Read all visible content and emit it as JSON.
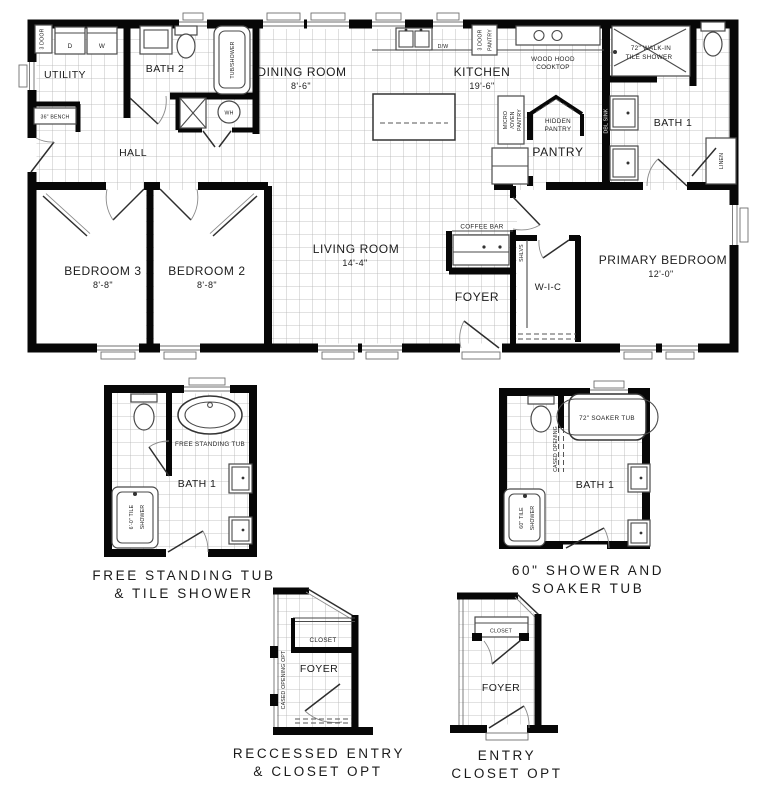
{
  "plan": {
    "rooms": {
      "utility": "UTILITY",
      "bath2": "BATH 2",
      "hall": "HALL",
      "dining": "DINING ROOM",
      "dining_dim": "8'-6\"",
      "kitchen": "KITCHEN",
      "kitchen_dim": "19'-6\"",
      "pantry": "PANTRY",
      "bath1": "BATH 1",
      "living": "LIVING ROOM",
      "living_dim": "14'-4\"",
      "foyer": "FOYER",
      "wic": "W-I-C",
      "primary": "PRIMARY BEDROOM",
      "primary_dim": "12'-0\"",
      "bedroom2": "BEDROOM 2",
      "bedroom2_dim": "8'-8\"",
      "bedroom3": "BEDROOM 3",
      "bedroom3_dim": "8'-8\""
    },
    "fixtures": {
      "linen3_line1": "3 DOOR",
      "linen3_line2": "LINEN",
      "dryer": "D",
      "washer": "W",
      "bench": "36\" BENCH",
      "tub_shower": "TUB/SHOWER",
      "water_heater": "WH",
      "dishwasher": "D/W",
      "pantry3_line1": "3 DOOR",
      "pantry3_line2": "PANTRY",
      "wood_hood_line1": "WOOD HOOD",
      "wood_hood_line2": "COOKTOP",
      "micro_line1": "MICRO",
      "micro_line2": "/OVEN",
      "micro_line3": "PANTRY",
      "hidden_line1": "HIDDEN",
      "hidden_line2": "PANTRY",
      "walkin_line1": "72\" WALK-IN",
      "walkin_line2": "TILE SHOWER",
      "dbl_sink": "DBL SINK",
      "linen": "LINEN",
      "coffee_bar": "COFFEE BAR",
      "shelves": "SHLVS"
    }
  },
  "options": {
    "free_tub": {
      "tub_label": "FREE STANDING TUB",
      "room": "BATH 1",
      "shower_line1": "6'-0\" TILE",
      "shower_line2": "SHOWER",
      "caption_line1": "FREE STANDING TUB",
      "caption_line2": "& TILE SHOWER"
    },
    "soaker": {
      "tub_label": "72\" SOAKER TUB",
      "opening": "CASED OPENING",
      "room": "BATH 1",
      "shower_line1": "60\" TILE",
      "shower_line2": "SHOWER",
      "caption_line1": "60\" SHOWER AND",
      "caption_line2": "SOAKER TUB"
    },
    "recessed": {
      "closet": "CLOSET",
      "foyer": "FOYER",
      "opening": "CASED OPENING OPT",
      "caption_line1": "RECCESSED ENTRY",
      "caption_line2": "& CLOSET OPT"
    },
    "entry": {
      "closet": "CLOSET",
      "foyer": "FOYER",
      "caption_line1": "ENTRY",
      "caption_line2": "CLOSET OPT"
    }
  },
  "colors": {
    "wall": "#070707",
    "grid": "#b3b3b3",
    "fixture": "#4a4a4a",
    "text": "#1c1c1c"
  }
}
